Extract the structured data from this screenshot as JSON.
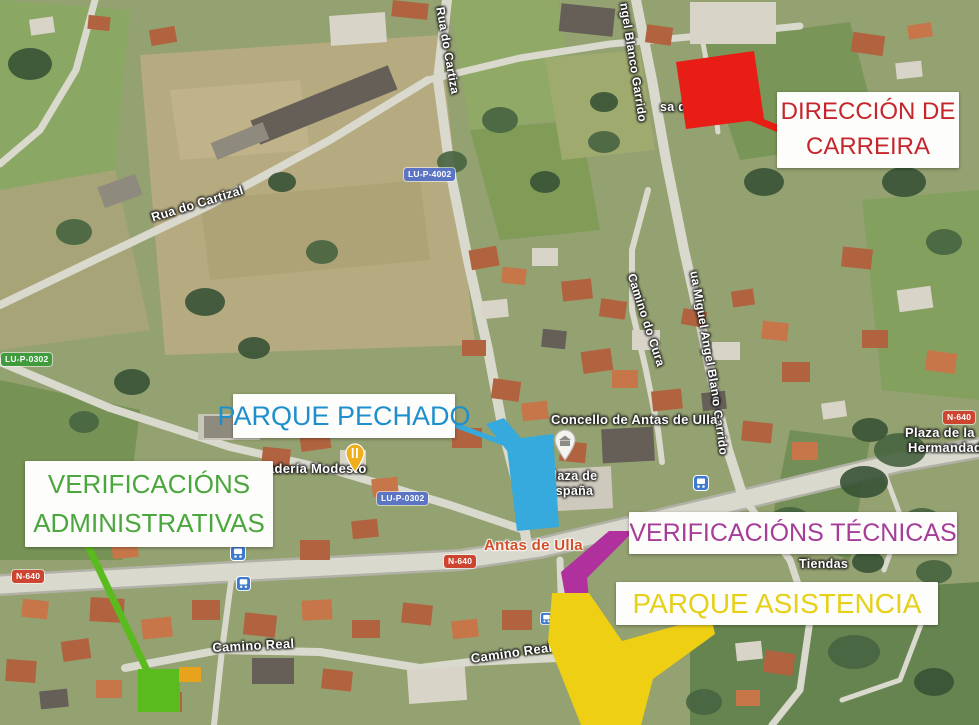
{
  "annotations": {
    "direccion": {
      "line1": "DIRECCIÓN DE",
      "line2": "CARREIRA",
      "text_color": "#c5262c",
      "marker_color": "#e81d15"
    },
    "pechado": {
      "label": "PARQUE PECHADO",
      "text_color": "#1e8fce",
      "marker_color": "#36a9dd"
    },
    "admin": {
      "line1": "VERIFICACIÓNS",
      "line2": "ADMINISTRATIVAS",
      "text_color": "#4ba63d",
      "marker_color": "#5abb1f",
      "extra_color": "#e8a31d"
    },
    "tecnicas": {
      "label": "VERIFICACIÓNS TÉCNICAS",
      "text_color": "#a63d99",
      "marker_color": "#b0309e"
    },
    "asistencia": {
      "label": "PARQUE ASISTENCIA",
      "text_color": "#e6d019",
      "marker_color": "#eecf13"
    }
  },
  "map_labels": {
    "town": "Antas de Ulla",
    "casa_cultura": "sa da Cultura",
    "concello": "Concello de Antas de Ulla",
    "plaza_espana_1": "Plaza de",
    "plaza_espana_2": "España",
    "plaza_hermandad_1": "Plaza de la",
    "plaza_hermandad_2": "Hermandad",
    "panaderia": "adería Modesto",
    "tiendas": "Tiendas",
    "rua_cartiza": "Rua do Cartiza",
    "blanco_garrido_top": "ngel Blanco Garrido",
    "rua_cartizal": "Rua do Cartizal",
    "camino_cura": "Camino do Cura",
    "miguel_angel": "ua Miguel Angel Blanc",
    "garrido_low": "o Garrido",
    "camino_real_w": "Camino Real",
    "camino_real_e": "Camino Real"
  },
  "badges": {
    "lup4002": "LU-P-4002",
    "lup0302": "LU-P-0302",
    "lup0302_w": "LU-P-0302",
    "n640_w": "N-640",
    "n640_c": "N-640",
    "n640_e": "N-640"
  },
  "icons": {
    "restaurant_pin": "yellow-pin-cutlery",
    "town_hall_pin": "light-pin-building",
    "bus_stop": "blue-square-bus"
  }
}
